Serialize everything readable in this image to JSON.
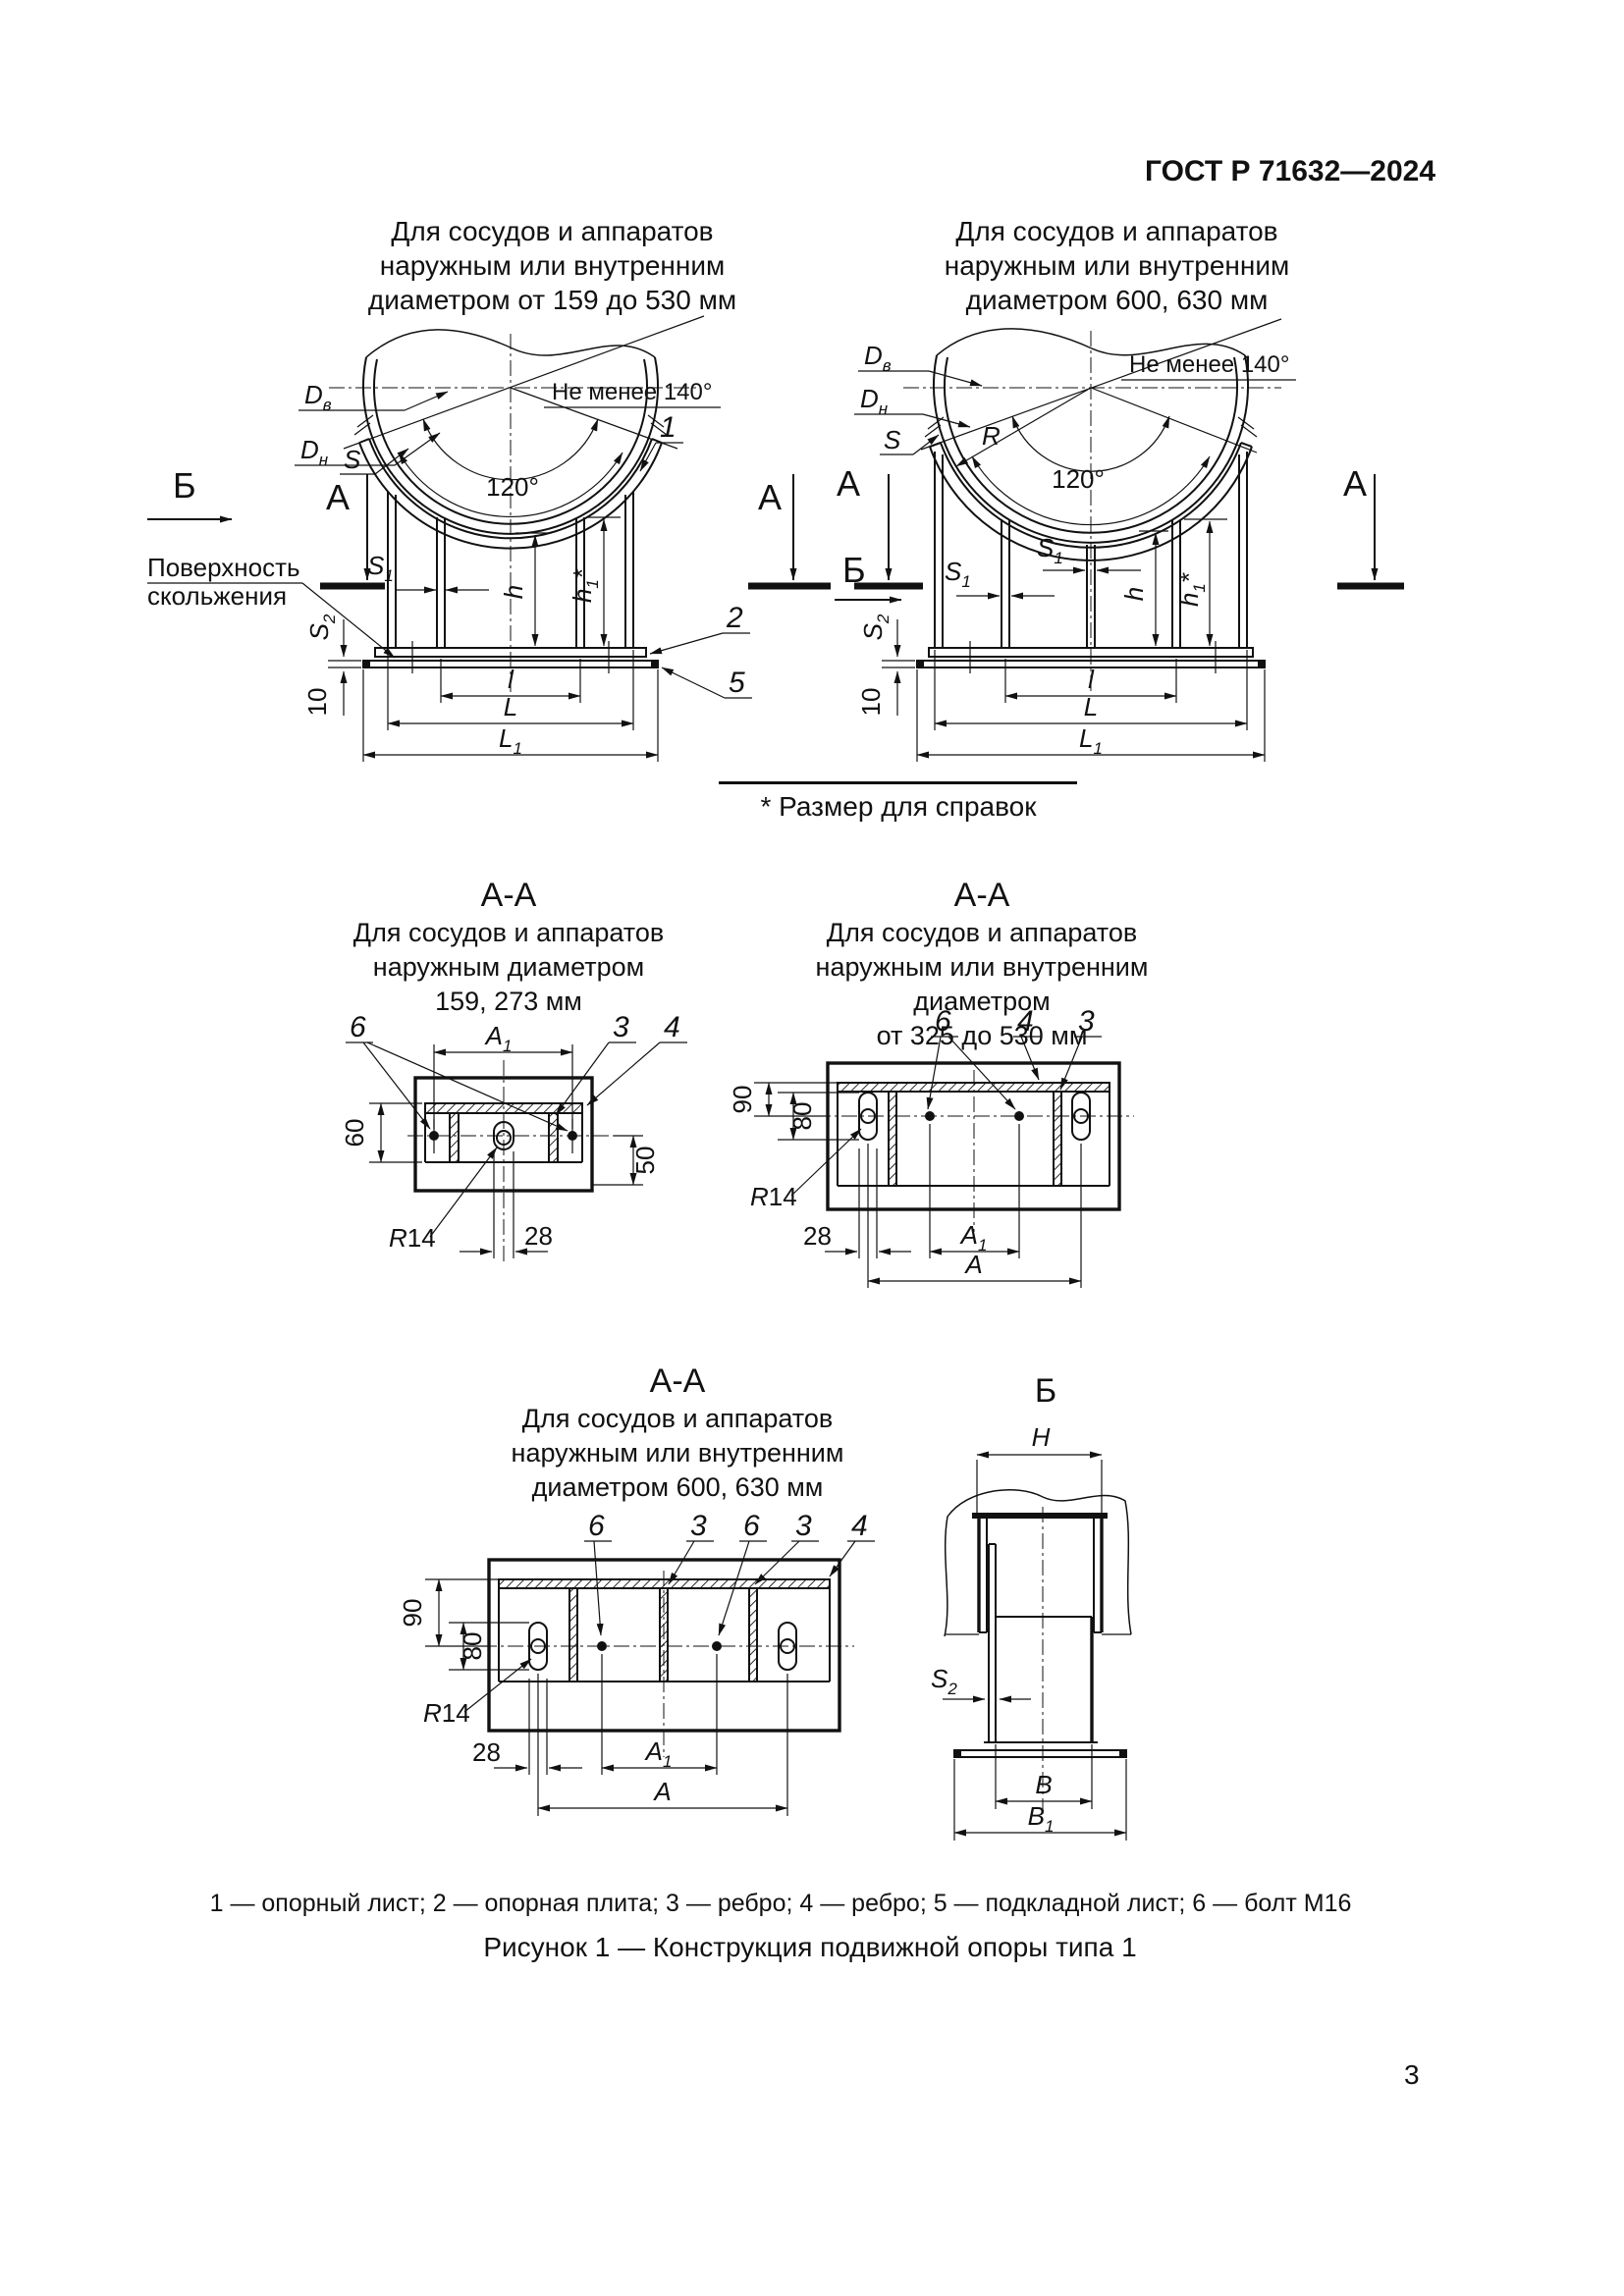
{
  "header": {
    "standard": "ГОСТ Р 71632—2024"
  },
  "page": {
    "number": "3"
  },
  "captions": {
    "top_left": [
      "Для сосудов и аппаратов",
      "наружным или внутренним",
      "диаметром от 159 до 530 мм"
    ],
    "top_right": [
      "Для сосудов и аппаратов",
      "наружным или внутренним",
      "диаметром 600, 630 мм"
    ]
  },
  "note": {
    "text": "* Размер для справок"
  },
  "sections": {
    "aa1": {
      "title": "А-А",
      "caption": [
        "Для сосудов и аппаратов",
        "наружным диаметром",
        "159, 273 мм"
      ]
    },
    "aa2": {
      "title": "А-А",
      "caption": [
        "Для сосудов и аппаратов",
        "наружным или внутренним диаметром",
        "от 325 до 530 мм"
      ]
    },
    "aa3": {
      "title": "А-А",
      "caption": [
        "Для сосудов и аппаратов",
        "наружным или внутренним",
        "диаметром 600, 630 мм"
      ]
    },
    "b": {
      "title": "Б"
    }
  },
  "lab": {
    "D": "D",
    "sub_v": "в",
    "sub_n": "н",
    "S": "S",
    "sub1": "1",
    "sub2": "2",
    "h": "h",
    "star": "*",
    "l": "l",
    "L": "L",
    "R": "R",
    "n10": "10",
    "n14": "14",
    "n28": "28",
    "n50": "50",
    "n60": "60",
    "n80": "80",
    "n90": "90",
    "a120": "120°",
    "min140": "Не менее 140°",
    "view_a": "А",
    "view_b": "Б",
    "surf1": "Поверхность",
    "surf2": "скольжения",
    "A": "A",
    "B": "B",
    "H": "H",
    "c1": "1",
    "c2": "2",
    "c3": "3",
    "c4": "4",
    "c5": "5",
    "c6": "6"
  },
  "legend": {
    "text": "1 — опорный лист; 2 — опорная плита; 3 — ребро; 4 — ребро; 5 — подкладной лист; 6 — болт М16"
  },
  "figure": {
    "caption": "Рисунок 1 — Конструкция подвижной опоры типа 1"
  }
}
